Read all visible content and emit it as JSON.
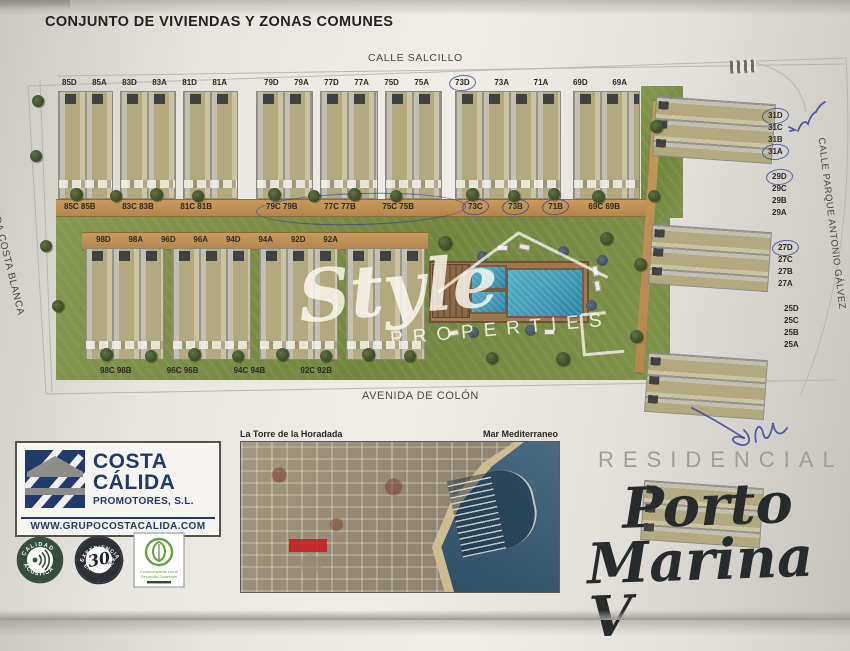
{
  "page": {
    "title": "CONJUNTO DE VIVIENDAS Y ZONAS COMUNES"
  },
  "plan": {
    "streets": {
      "top": "CALLE SALCILLO",
      "left": "AVENIDA COSTA BLANCA",
      "bottom": "AVENIDA DE COLÓN",
      "right": "CALLE PARQUE ANTONIO GÁLVEZ"
    },
    "row1": {
      "group1": {
        "top": [
          "85D",
          "85A",
          "83D",
          "83A",
          "81D",
          "81A"
        ],
        "bottom": [
          "85C 85B",
          "83C 83B",
          "81C 81B"
        ]
      },
      "group2": {
        "top": [
          "79D",
          "79A",
          "77D",
          "77A",
          "75D",
          "75A"
        ],
        "bottom": [
          "79C 79B",
          "77C 77B",
          "75C 75B"
        ]
      },
      "group3": {
        "top": [
          {
            "label": "73D",
            "circled": true
          },
          "73A",
          "71A",
          "69D",
          "69A"
        ],
        "bottom": [
          {
            "label": "73C",
            "circled": true
          },
          {
            "label": "73B",
            "circled": true
          },
          {
            "label": "71B",
            "circled": true
          },
          "69C 69B"
        ]
      }
    },
    "row2": {
      "top": [
        "98D",
        "98A",
        "96D",
        "96A",
        "94D",
        "94A",
        "92D",
        "92A"
      ],
      "bottom": [
        "98C 98B",
        "96C 96B",
        "94C 94B",
        "92C 92B"
      ]
    },
    "right_groups": [
      [
        {
          "label": "31D",
          "circled": true
        },
        "31C",
        "31B",
        {
          "label": "31A",
          "circled": true
        }
      ],
      [
        {
          "label": "29D",
          "circled": true
        },
        "29C",
        "29B",
        "29A"
      ],
      [
        {
          "label": "27D",
          "circled": true
        },
        "27C",
        "27B",
        "27A"
      ],
      [
        "25D",
        "25C",
        "25B",
        "25A"
      ]
    ]
  },
  "watermark": {
    "script": "Style",
    "caps": "PROPERTIES"
  },
  "branding": {
    "logo": {
      "line1": "COSTA",
      "line2": "CÁLIDA",
      "line3": "PROMOTORES, S.L.",
      "website": "WWW.GRUPOCOSTACALIDA.COM"
    },
    "badges": {
      "acoustic_top": "CALIDAD",
      "acoustic_bottom": "ACÚSTICA",
      "experience_top": "EXPERIENCIA",
      "experience_number": "30",
      "experience_small": "Años Years",
      "experience_bottom": "EXPERIENCE",
      "sustain_line1": "Comprometidos con el",
      "sustain_line2": "Desarrollo Sostenible"
    }
  },
  "map": {
    "label_left": "La Torre de la Horadada",
    "label_right": "Mar Mediterraneo"
  },
  "residencial": {
    "kicker": "RESIDENCIAL",
    "name1": "Porto",
    "name2": "Marina V"
  },
  "colors": {
    "paper": "#efece7",
    "navy": "#223a6b",
    "lawn": "#7d8f4a",
    "pool": "#3e96b4",
    "path_tan": "#c0955c",
    "pen_ink": "#3d4da0"
  }
}
